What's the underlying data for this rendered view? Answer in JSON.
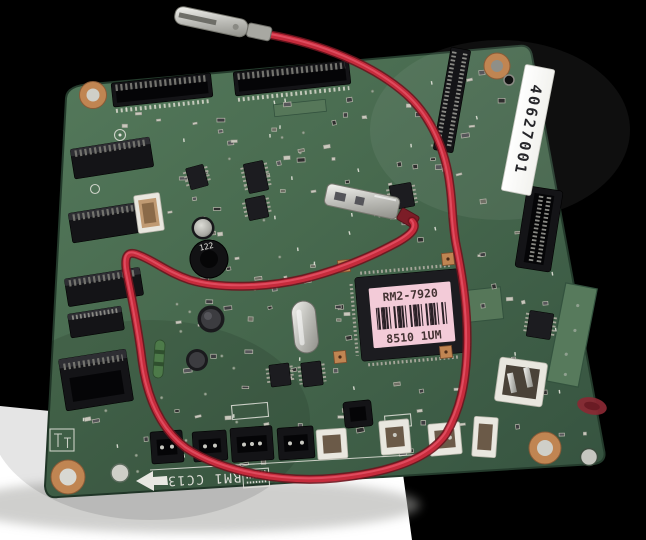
{
  "labels": {
    "serial_sticker": "40627001",
    "ic_label_model": "RM2-7920",
    "ic_label_code": "8510 1UM",
    "silkscreen_marking": "RM1 CC13",
    "inductor_value": "122"
  },
  "colors": {
    "background": "#000000",
    "table": "#ffffff",
    "pcb_green": "#47694e",
    "wire_red": "#c62b3c",
    "label_pink": "#f3cbd8",
    "copper": "#c08552",
    "connector_black": "#141417",
    "sticker_white": "#f2f2ee"
  }
}
